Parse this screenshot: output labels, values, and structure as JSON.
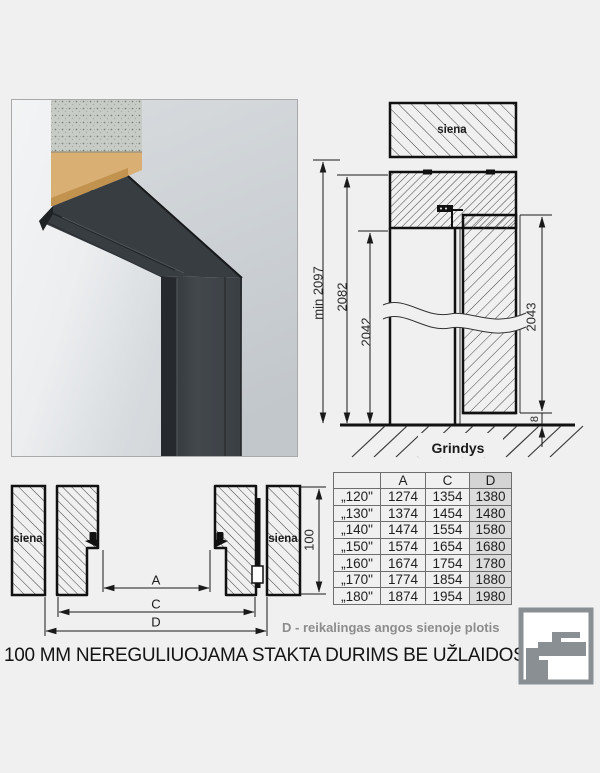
{
  "page": {
    "background": "#f0f0f0",
    "caption": "100 MM NEREGULIUOJAMA STAKTA DURIMS BE UŽLAIDOS",
    "d_note": "D - reikalingas angos sienoje plotis"
  },
  "vertical_section": {
    "wall_label": "siena",
    "floor_label": "Grindys",
    "dim_min_total": "min 2097",
    "dim_frame_height": "2082",
    "dim_opening_height": "2042",
    "dim_leaf_height": "2043",
    "dim_floor_gap": "8"
  },
  "horizontal_section": {
    "wall_label_left": "siena",
    "wall_label_right": "siena",
    "dim_a_label": "A",
    "dim_c_label": "C",
    "dim_d_label": "D",
    "dim_frame_depth": "100"
  },
  "size_table": {
    "columns": [
      "",
      "A",
      "C",
      "D"
    ],
    "rows": [
      {
        "size": "„120\"",
        "a": "1274",
        "c": "1354",
        "d": "1380"
      },
      {
        "size": "„130\"",
        "a": "1374",
        "c": "1454",
        "d": "1480"
      },
      {
        "size": "„140\"",
        "a": "1474",
        "c": "1554",
        "d": "1580"
      },
      {
        "size": "„150\"",
        "a": "1574",
        "c": "1654",
        "d": "1680"
      },
      {
        "size": "„160\"",
        "a": "1674",
        "c": "1754",
        "d": "1780"
      },
      {
        "size": "„170\"",
        "a": "1774",
        "c": "1854",
        "d": "1880"
      },
      {
        "size": "„180\"",
        "a": "1874",
        "c": "1954",
        "d": "1980"
      }
    ],
    "highlight_column": "D",
    "highlight_color": "#dcdcdc"
  },
  "colors": {
    "line": "#1a1a1a",
    "frame_anthracite": "#383d42",
    "chipboard_tan": "#d9af74",
    "logo_gray": "#8a8f93",
    "note_gray": "#8c8c8c"
  }
}
